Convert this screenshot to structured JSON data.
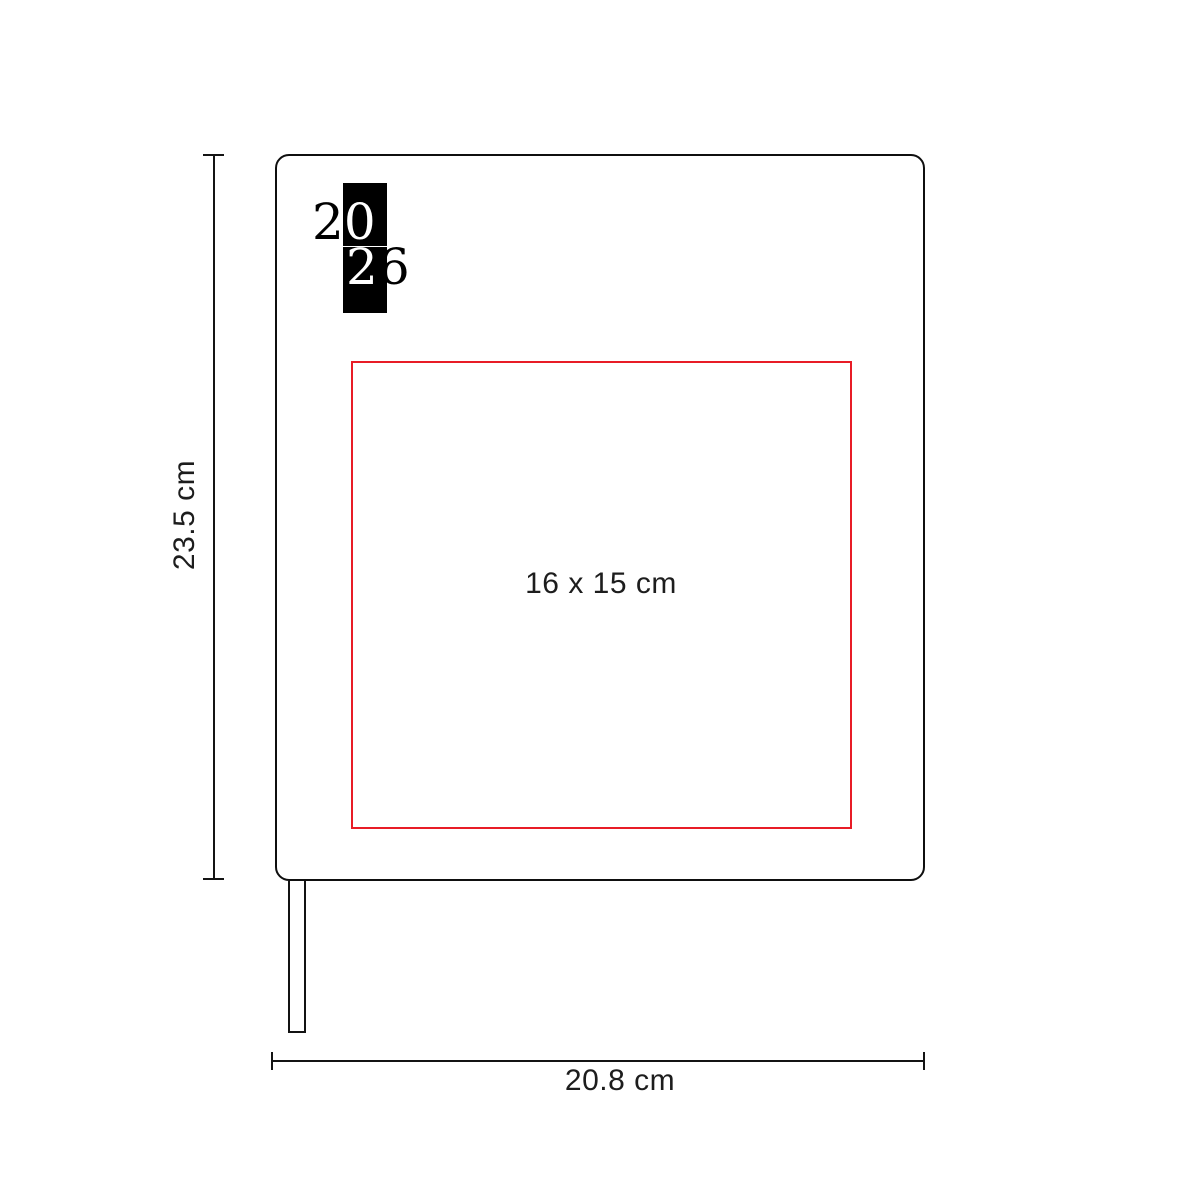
{
  "logo": {
    "year": "2026",
    "row1_outside": "2",
    "row1_inverted": "0",
    "row2_inverted": "2",
    "row2_outside": "6"
  },
  "print_area": {
    "label": "16 x 15 cm",
    "border_color": "#e81c26"
  },
  "dimensions": {
    "height": "23.5 cm",
    "width": "20.8 cm"
  },
  "colors": {
    "outline": "#0f0f0f",
    "logo_block": "#000000",
    "background": "#ffffff",
    "label_text": "#1d1d1d"
  }
}
